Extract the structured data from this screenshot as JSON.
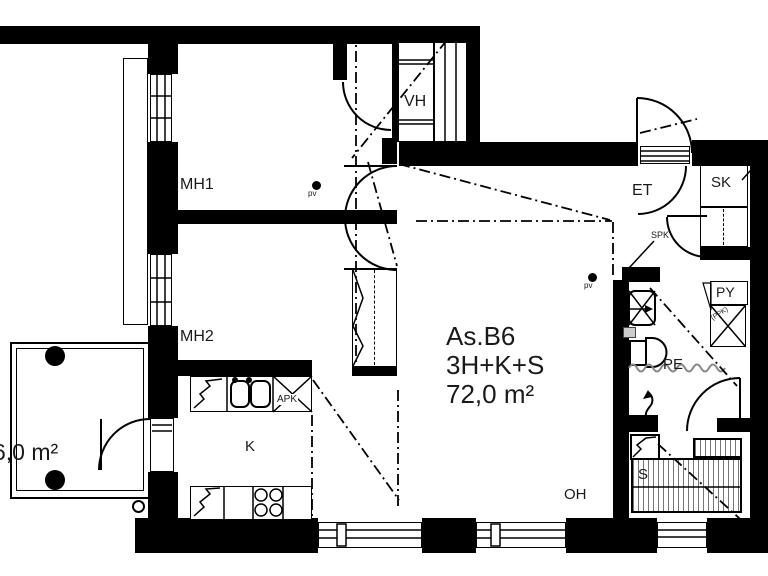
{
  "apartment": {
    "id": "As.B6",
    "layout": "3H+K+S",
    "area": "72,0 m²"
  },
  "rooms": {
    "mh1": "MH1",
    "mh2": "MH2",
    "vh": "VH",
    "et": "ET",
    "sk": "SK",
    "py": "PY",
    "pe": "PE",
    "sauna": "S",
    "kitchen": "K",
    "oh": "OH"
  },
  "balcony": {
    "area": "6,0 m²"
  },
  "annotations": {
    "pv": "pv",
    "spk": "SPK",
    "apk": "APK",
    "ppk": "(PPK)"
  },
  "colors": {
    "wall": "#000000",
    "background": "#ffffff",
    "hatch": "#777777",
    "wave": "#888888"
  }
}
